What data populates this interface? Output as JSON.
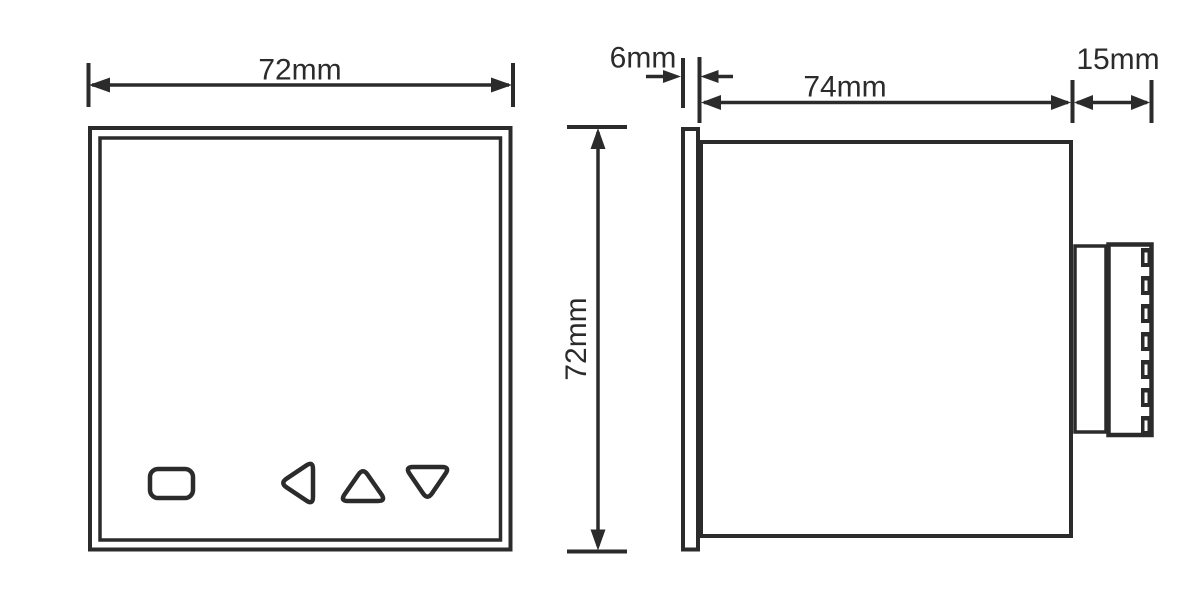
{
  "line_color": "#2b2b2b",
  "front_view": {
    "width_dimension": "72mm"
  },
  "side_view": {
    "height_dimension": "72mm",
    "bezel_dimension": "6mm",
    "body_dimension": "74mm",
    "terminal_dimension": "15mm"
  }
}
